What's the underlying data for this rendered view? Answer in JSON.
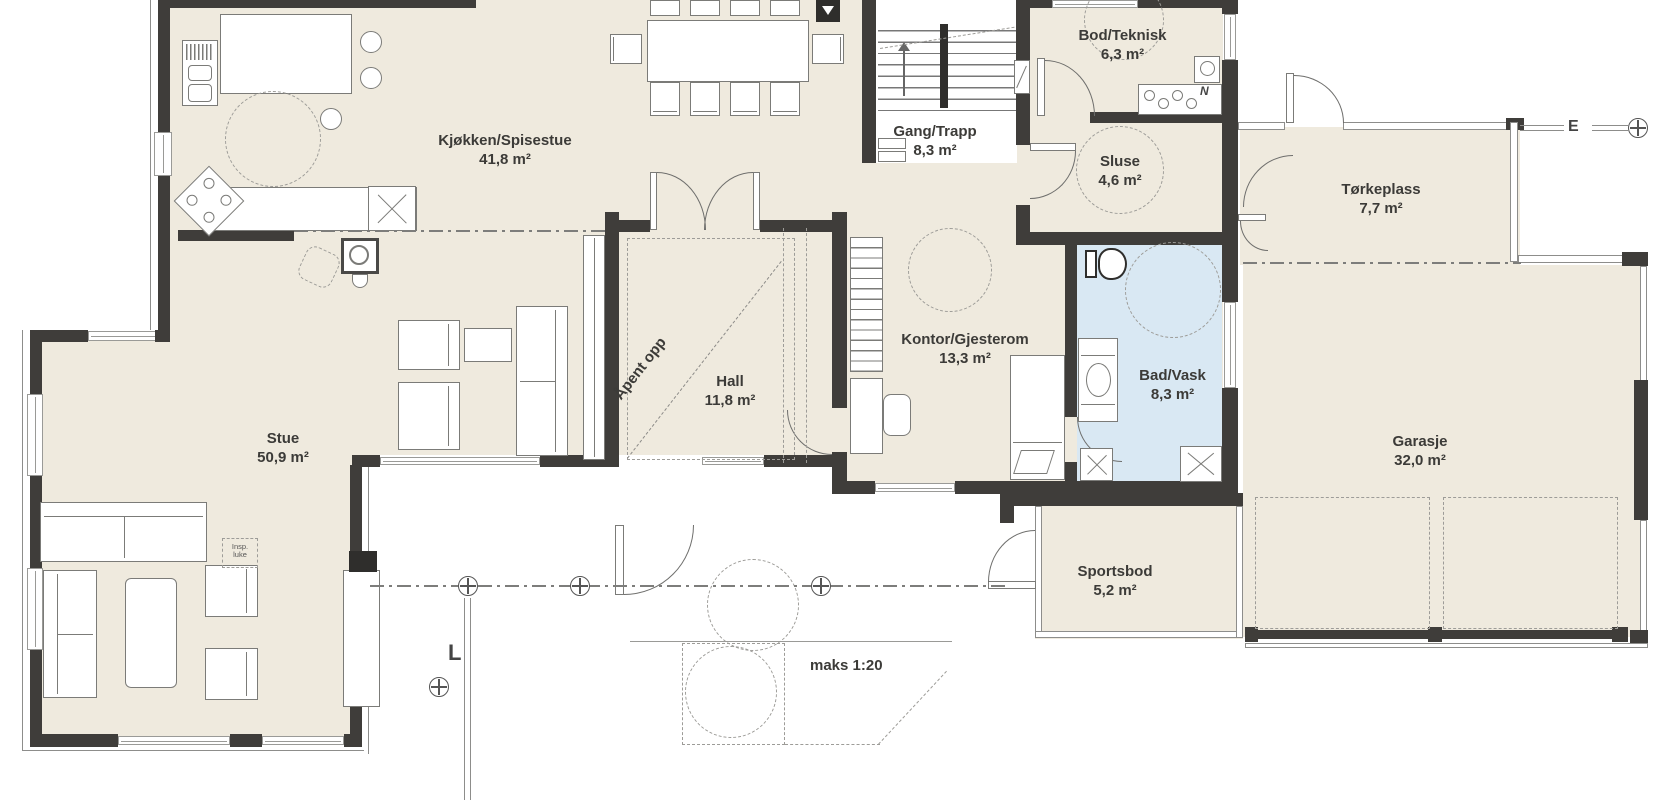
{
  "colors": {
    "room_fill": "#efeade",
    "bath_fill": "#d9e8f3",
    "wall": "#3f3d3a",
    "line_gray": "#7b7b78",
    "dash_gray": "#9d9c98"
  },
  "rooms": {
    "kjokken": {
      "name": "Kjøkken/Spisestue",
      "area": "41,8 m²"
    },
    "gang": {
      "name": "Gang/Trapp",
      "area": "8,3 m²"
    },
    "bod": {
      "name": "Bod/Teknisk",
      "area": "6,3 m²"
    },
    "sluse": {
      "name": "Sluse",
      "area": "4,6 m²"
    },
    "torkeplass": {
      "name": "Tørkeplass",
      "area": "7,7 m²"
    },
    "hall": {
      "name": "Hall",
      "area": "11,8 m²"
    },
    "kontor": {
      "name": "Kontor/Gjesterom",
      "area": "13,3 m²"
    },
    "bad": {
      "name": "Bad/Vask",
      "area": "8,3 m²"
    },
    "stue": {
      "name": "Stue",
      "area": "50,9 m²"
    },
    "sportsbod": {
      "name": "Sportsbod",
      "area": "5,2 m²"
    },
    "garasje": {
      "name": "Garasje",
      "area": "32,0 m²"
    }
  },
  "annotations": {
    "apent_opp": "Åpent opp",
    "maks_helning": "maks 1:20",
    "insp_line1": "Insp.",
    "insp_line2": "luke",
    "grid_letter_east": "E",
    "grid_letter_south": "L",
    "vent_symbol": "N"
  }
}
